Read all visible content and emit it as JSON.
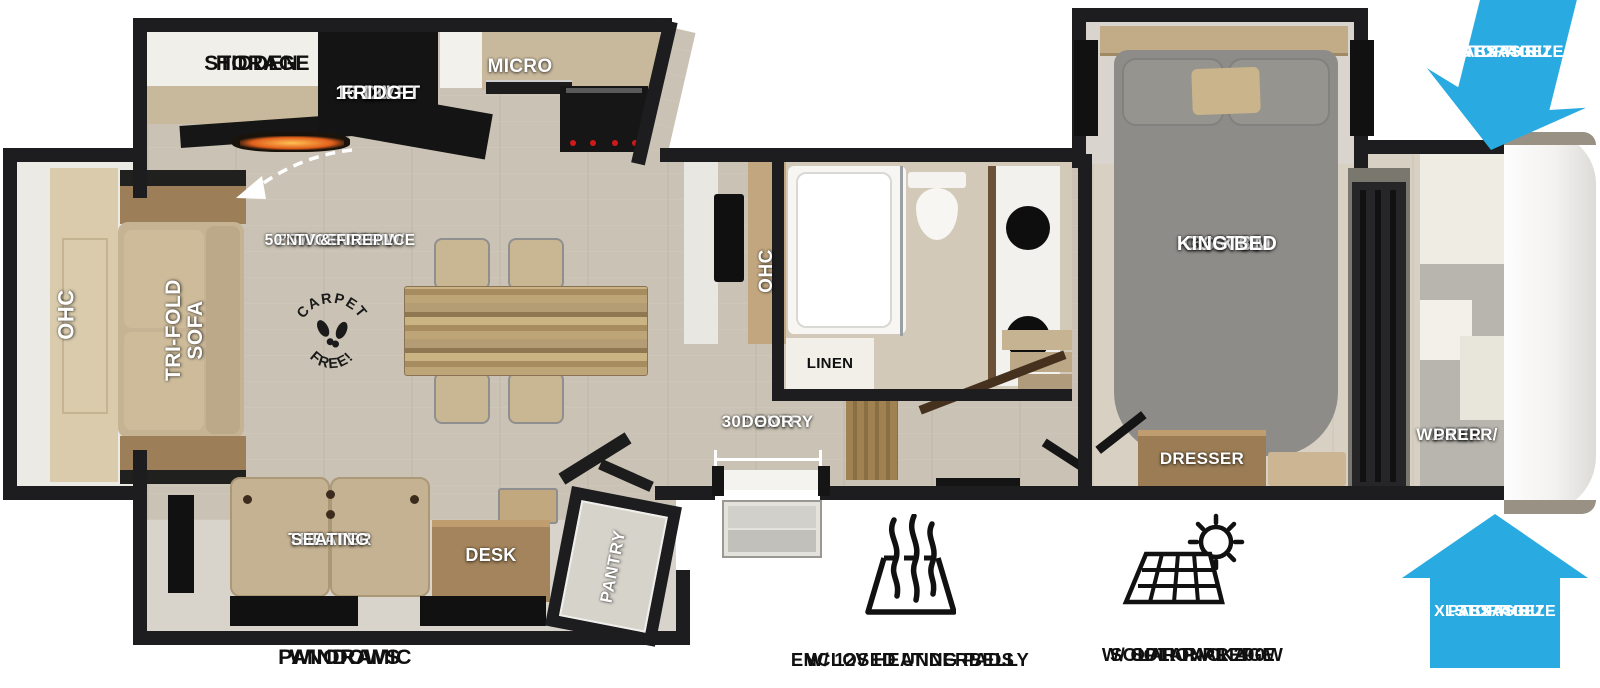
{
  "meta": {
    "type": "rv-fifth-wheel-floorplan"
  },
  "colors": {
    "pass_thru_blue": "#29abe2",
    "wall": "#1d1d1f",
    "floor": "#cac3b5",
    "bedroom_floor": "#d8d1c3",
    "wood": "#a98e67",
    "sofa_tan": "#c6b394",
    "bed_gray": "#8e8c89"
  },
  "labels": {
    "hidden_storage": [
      "HIDDEN",
      "STORAGE"
    ],
    "fridge": [
      "16 CU FT",
      "12V",
      "FRIDGE"
    ],
    "micro": "MICRO",
    "ent_center": [
      "SWING-OPEN",
      "ENT. CENTER W/",
      "50” TV & FIREPLCE"
    ],
    "carpet_stamp": {
      "top": "CARPET",
      "bottom": "FREE!"
    },
    "ohc_rear": "OHC",
    "trifold_sofa": [
      "TRI-FOLD",
      "SOFA"
    ],
    "ohc_kitchen": "OHC",
    "linen": "LINEN",
    "king_bed": [
      "66 X 80",
      "CUSTOM",
      "KING BED"
    ],
    "washer_prep": [
      "WASHER/",
      "DYER",
      "PREP"
    ],
    "dresser": "DRESSER",
    "entry_door": [
      "30” ENTRY",
      "DOOR"
    ],
    "theater_seating": [
      "THEATER",
      "SEATING"
    ],
    "desk": "DESK",
    "pantry": "PANTRY"
  },
  "callouts": {
    "panoramic_windows": [
      "PANORAMIC",
      "WINDOWS"
    ],
    "underbelly": [
      "ENCLOSED UNDERBELLY",
      "W/ 12V HEATING PADS"
    ],
    "solar": [
      "SOLAR PREP",
      "W/ OPTIONAL 200W",
      "SOLAR PACKAGE"
    ],
    "pass_thru_top": [
      "XL TEXAS SIZE",
      "PASS THRU",
      "STORAGE"
    ],
    "pass_thru_bottom": [
      "XL TEXAS SIZE",
      "PASS THRU",
      "STORAGE"
    ]
  },
  "icons": {
    "underbelly": "heating-pad-with-heat-waves",
    "solar": "solar-panel-with-sun",
    "pass_thru_top": "large-blue-arrow-pointing-down",
    "pass_thru_bottom": "large-blue-arrow-pointing-up",
    "ent_center": "dashed-curved-arrow",
    "carpet_free": "circular-stamp-with-boot-prints"
  }
}
